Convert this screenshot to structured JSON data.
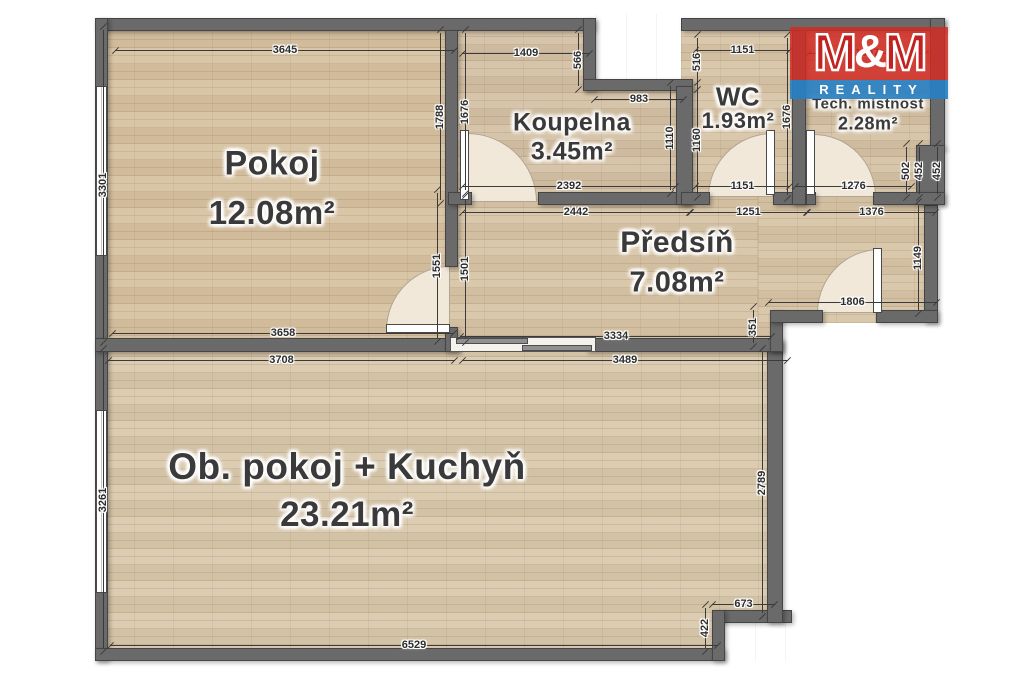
{
  "plan": {
    "type": "apartment-floor-plan"
  },
  "colors": {
    "wall": "#6a6a6a",
    "floor": "#d8c5a7",
    "logo_red": "#d12b24",
    "logo_blue": "#2680c4",
    "dim_text": "#2d2d2d"
  },
  "logo": {
    "m1": "M",
    "amp": "&",
    "m2": "M",
    "line2": "REALITY"
  },
  "rooms": [
    {
      "key": "pokoj",
      "name": "Pokoj",
      "area": "12.08m²",
      "cx": 272,
      "name_cy": 164,
      "area_cy": 213,
      "name_size": 34,
      "area_size": 33
    },
    {
      "key": "koupelna",
      "name": "Koupelna",
      "area": "3.45m²",
      "cx": 572,
      "name_cy": 123,
      "area_cy": 152,
      "name_size": 25,
      "area_size": 25
    },
    {
      "key": "wc",
      "name": "WC",
      "area": "1.93m²",
      "cx": 738,
      "name_cy": 97,
      "area_cy": 121,
      "name_size": 26,
      "area_size": 22
    },
    {
      "key": "tech",
      "name": "Tech. místnost",
      "area": "2.28m²",
      "cx": 868,
      "name_cy": 104,
      "area_cy": 124,
      "name_size": 15,
      "area_size": 18
    },
    {
      "key": "predsin",
      "name": "Předsíň",
      "area": "7.08m²",
      "cx": 677,
      "name_cy": 243,
      "area_cy": 283,
      "name_size": 30,
      "area_size": 29
    },
    {
      "key": "obpokoj",
      "name": "Ob. pokoj + Kuchyň",
      "area": "23.21m²",
      "cx": 347,
      "name_cy": 467,
      "area_cy": 515,
      "name_size": 37,
      "area_size": 35
    }
  ],
  "dimensions": [
    {
      "label": "3645",
      "x": 115,
      "y": 50,
      "len": 340,
      "v": 0
    },
    {
      "label": "1409",
      "x": 462,
      "y": 53,
      "len": 128,
      "v": 0
    },
    {
      "label": "983",
      "x": 594,
      "y": 99,
      "len": 90,
      "v": 0
    },
    {
      "label": "1151",
      "x": 695,
      "y": 50,
      "len": 95,
      "v": 0
    },
    {
      "label": "1397",
      "x": 808,
      "y": 53,
      "len": 118,
      "v": 0
    },
    {
      "label": "2392",
      "x": 462,
      "y": 186,
      "len": 214,
      "v": 0
    },
    {
      "label": "1151",
      "x": 695,
      "y": 186,
      "len": 95,
      "v": 0
    },
    {
      "label": "1276",
      "x": 795,
      "y": 186,
      "len": 117,
      "v": 0
    },
    {
      "label": "2442",
      "x": 462,
      "y": 212,
      "len": 228,
      "v": 0
    },
    {
      "label": "1251",
      "x": 690,
      "y": 212,
      "len": 117,
      "v": 0
    },
    {
      "label": "1376",
      "x": 807,
      "y": 212,
      "len": 129,
      "v": 0
    },
    {
      "label": "1806",
      "x": 768,
      "y": 302,
      "len": 169,
      "v": 0
    },
    {
      "label": "3334",
      "x": 460,
      "y": 336,
      "len": 312,
      "v": 0
    },
    {
      "label": "3658",
      "x": 112,
      "y": 333,
      "len": 342,
      "v": 0
    },
    {
      "label": "3708",
      "x": 108,
      "y": 360,
      "len": 347,
      "v": 0
    },
    {
      "label": "3489",
      "x": 462,
      "y": 360,
      "len": 326,
      "v": 0
    },
    {
      "label": "673",
      "x": 712,
      "y": 604,
      "len": 63,
      "v": 0
    },
    {
      "label": "6529",
      "x": 110,
      "y": 645,
      "len": 608,
      "v": 0
    },
    {
      "label": "3301",
      "x": 103,
      "y": 30,
      "len": 309,
      "v": 1
    },
    {
      "label": "1788",
      "x": 440,
      "y": 33,
      "len": 167,
      "v": 1
    },
    {
      "label": "1676",
      "x": 465,
      "y": 33,
      "len": 157,
      "v": 1
    },
    {
      "label": "566",
      "x": 578,
      "y": 33,
      "len": 53,
      "v": 1
    },
    {
      "label": "516",
      "x": 697,
      "y": 38,
      "len": 48,
      "v": 1
    },
    {
      "label": "1160",
      "x": 697,
      "y": 86,
      "len": 108,
      "v": 1
    },
    {
      "label": "1110",
      "x": 670,
      "y": 86,
      "len": 104,
      "v": 1
    },
    {
      "label": "1676",
      "x": 787,
      "y": 38,
      "len": 157,
      "v": 1
    },
    {
      "label": "502",
      "x": 906,
      "y": 147,
      "len": 47,
      "v": 1
    },
    {
      "label": "452",
      "x": 919,
      "y": 147,
      "len": 47,
      "v": 1
    },
    {
      "label": "452",
      "x": 937,
      "y": 147,
      "len": 47,
      "v": 1
    },
    {
      "label": "1149",
      "x": 918,
      "y": 205,
      "len": 105,
      "v": 1
    },
    {
      "label": "351",
      "x": 753,
      "y": 310,
      "len": 33,
      "v": 1
    },
    {
      "label": "1551",
      "x": 437,
      "y": 193,
      "len": 145,
      "v": 1
    },
    {
      "label": "1501",
      "x": 465,
      "y": 199,
      "len": 140,
      "v": 1
    },
    {
      "label": "3261",
      "x": 103,
      "y": 352,
      "len": 296,
      "v": 1
    },
    {
      "label": "2789",
      "x": 762,
      "y": 352,
      "len": 261,
      "v": 1
    },
    {
      "label": "422",
      "x": 705,
      "y": 608,
      "len": 40,
      "v": 1
    }
  ]
}
